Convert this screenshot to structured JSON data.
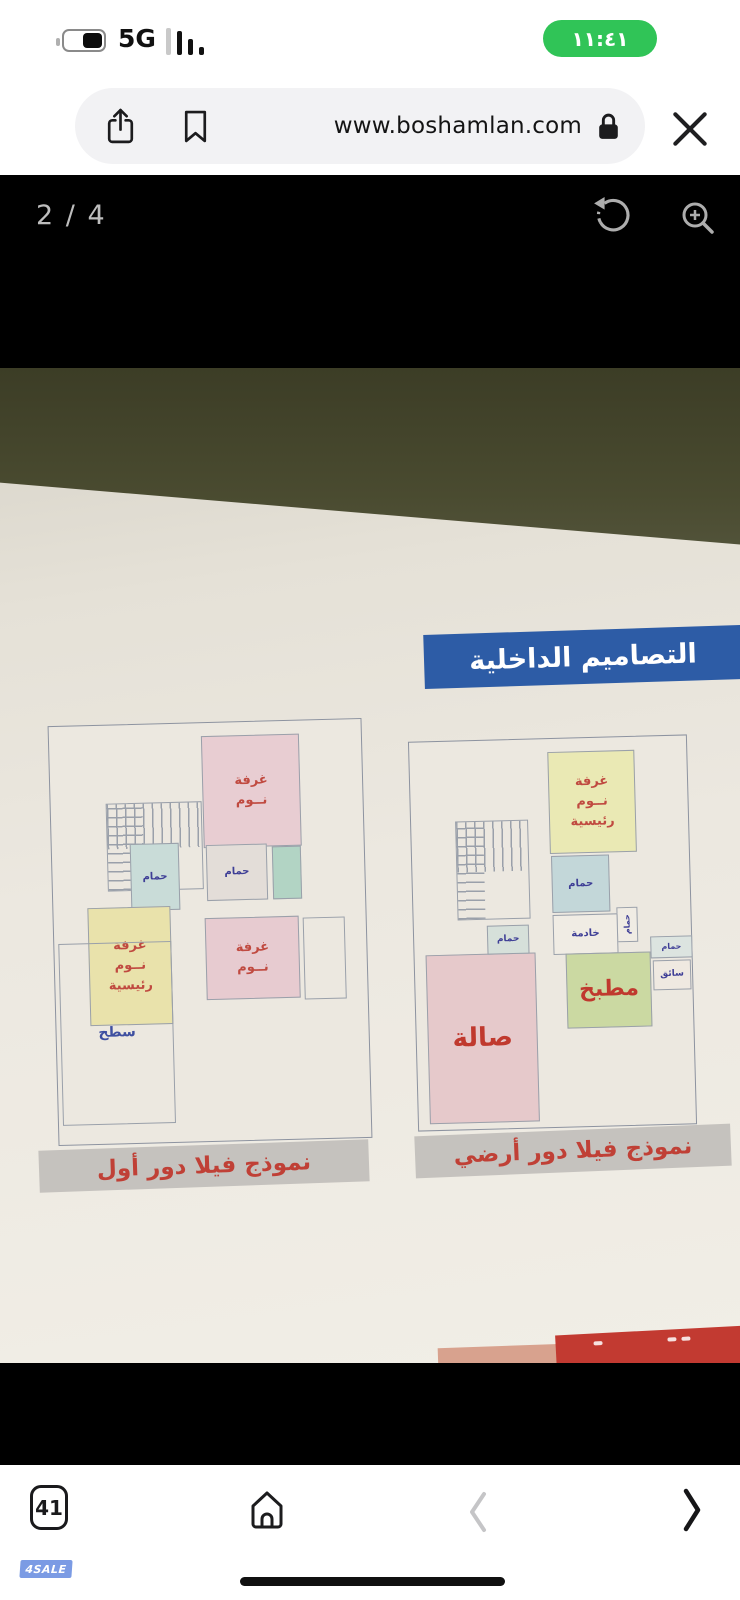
{
  "status_bar": {
    "time": "١١:٤١",
    "network": "5G"
  },
  "browser_toolbar": {
    "url": "www.boshamlan.com"
  },
  "image_viewer": {
    "counter": "2 / 4"
  },
  "photo": {
    "header_banner": "التصاميم الداخلية",
    "plans": [
      {
        "name": "first-floor",
        "caption": "نموذج فيلا دور أول",
        "rooms": [
          {
            "name": "bedroom-top",
            "label": "غرفة\nنــوم",
            "color": "#e8cdd2",
            "text_color": "#c04a40",
            "font": 13,
            "rect": [
              152,
              13,
              98,
              112
            ]
          },
          {
            "name": "stairs",
            "class": "stairs",
            "rect": [
              55,
              78,
              96,
              88
            ]
          },
          {
            "name": "bathroom-left",
            "label": "حمام",
            "color": "#c9dcd8",
            "text_color": "#3e3e96",
            "font": 10,
            "rect": [
              78,
              119,
              49,
              67
            ]
          },
          {
            "name": "bathroom-middle",
            "label": "حمام",
            "color": "#e3ddd8",
            "text_color": "#3e3e96",
            "font": 10,
            "rect": [
              154,
              122,
              61,
              56
            ]
          },
          {
            "name": "dressing-room",
            "color": "#b2d4c4",
            "rect": [
              220,
              125,
              29,
              53
            ]
          },
          {
            "name": "bedroom-middle",
            "label": "غرفة\nنــوم",
            "color": "#e7cbd0",
            "text_color": "#c04a40",
            "font": 13,
            "rect": [
              151,
              195,
              94,
              82
            ]
          },
          {
            "name": "balcony",
            "color": "transparent",
            "rect": [
              249,
              197,
              42,
              82
            ]
          },
          {
            "name": "master-bedroom",
            "label": "غرفة\nنــوم\nرئيسية",
            "color": "#e9e2ab",
            "text_color": "#c04a40",
            "font": 13,
            "rect": [
              34,
              182,
              83,
              118
            ]
          },
          {
            "name": "roof-terrace",
            "label": "سطح",
            "color": "transparent",
            "text_color": "#3e4fa0",
            "font": 14,
            "rect": [
              4,
              217,
              113,
              182
            ]
          }
        ]
      },
      {
        "name": "ground-floor",
        "caption": "نموذج فيلا دور أرضي",
        "rooms": [
          {
            "name": "master-bedroom",
            "label": "غرفة\nنــوم\nرئيسية",
            "color": "#eae9b4",
            "text_color": "#c04a40",
            "font": 13,
            "rect": [
              138,
              13,
              87,
              102
            ]
          },
          {
            "name": "stairs",
            "class": "stairs",
            "rect": [
              44,
              80,
              73,
              99
            ]
          },
          {
            "name": "bathroom",
            "label": "حمام",
            "color": "#c3d7d9",
            "text_color": "#3e3e96",
            "font": 10,
            "rect": [
              139,
              117,
              58,
              57
            ]
          },
          {
            "name": "bathroom-small",
            "label": "حمام",
            "vertical": true,
            "color": "#f0ece4",
            "text_color": "#3e3e96",
            "font": 8,
            "rect": [
              203,
              170,
              21,
              35
            ]
          },
          {
            "name": "maid-room",
            "label": "خادمة",
            "color": "#f0ece4",
            "text_color": "#3e3e96",
            "font": 10,
            "rect": [
              139,
              176,
              65,
              40
            ]
          },
          {
            "name": "guest-bathroom",
            "label": "حمام",
            "color": "#dce4e0",
            "text_color": "#3e3e96",
            "font": 8,
            "rect": [
              236,
              200,
              42,
              22
            ]
          },
          {
            "name": "driver-room",
            "label": "سائق",
            "color": "#efe9e1",
            "text_color": "#3e3e96",
            "font": 9,
            "rect": [
              238,
              224,
              38,
              30
            ]
          },
          {
            "name": "kitchen",
            "label": "مطبخ",
            "color": "#cbd9a2",
            "text_color": "#c0392e",
            "font": 22,
            "rect": [
              151,
              215,
              85,
              75
            ]
          },
          {
            "name": "hall",
            "label": "صالة",
            "color": "#e6c9cb",
            "text_color": "#c0392e",
            "font": 26,
            "rect": [
              11,
              213,
              110,
              169
            ]
          },
          {
            "name": "hall-bathroom",
            "label": "حمام",
            "color": "#d6e0da",
            "text_color": "#3e3e96",
            "font": 9,
            "rect": [
              73,
              185,
              42,
              29
            ]
          }
        ]
      }
    ]
  },
  "pagination": {
    "total": 4,
    "active_index": 1
  },
  "bottom_nav": {
    "tab_count": "41"
  },
  "watermark": "4SALE",
  "colors": {
    "time_pill_green": "#30c457",
    "banner_blue": "#2d5ca6",
    "caption_gray": "#c5c2be",
    "label_red": "#c0392e",
    "label_blue": "#3e3e96",
    "active_dot_blue": "#2e7ad0",
    "paper": "#ece8e0",
    "table_olive": "#45462b",
    "watermark_blue": "#7b9be4"
  }
}
